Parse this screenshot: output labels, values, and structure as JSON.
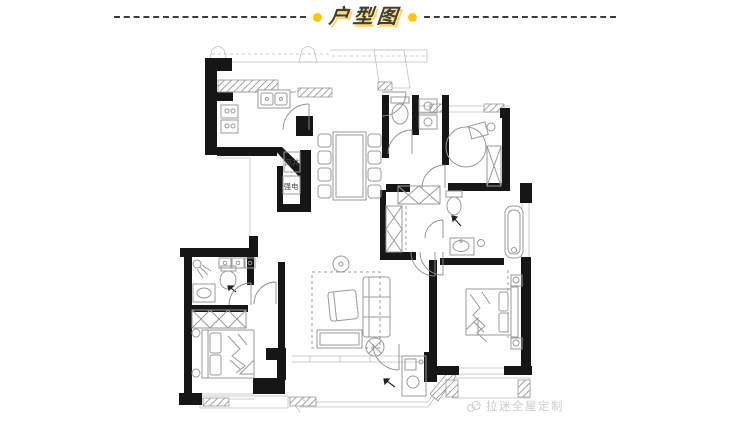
{
  "header": {
    "title": "户型图"
  },
  "plan": {
    "labels": {
      "air_shaft": "风井",
      "strong_electric": "强电"
    }
  },
  "watermark": {
    "brand": "拉迷全屋定制"
  },
  "colors": {
    "accent_dot_yellow": "#ffc60a",
    "title_shadow_yellow": "#ffd94f",
    "title_text": "#3e3e3e",
    "wall_black": "#161616",
    "furniture_gray": "#9a9a9a",
    "watermark_gray": "#cccccc"
  }
}
